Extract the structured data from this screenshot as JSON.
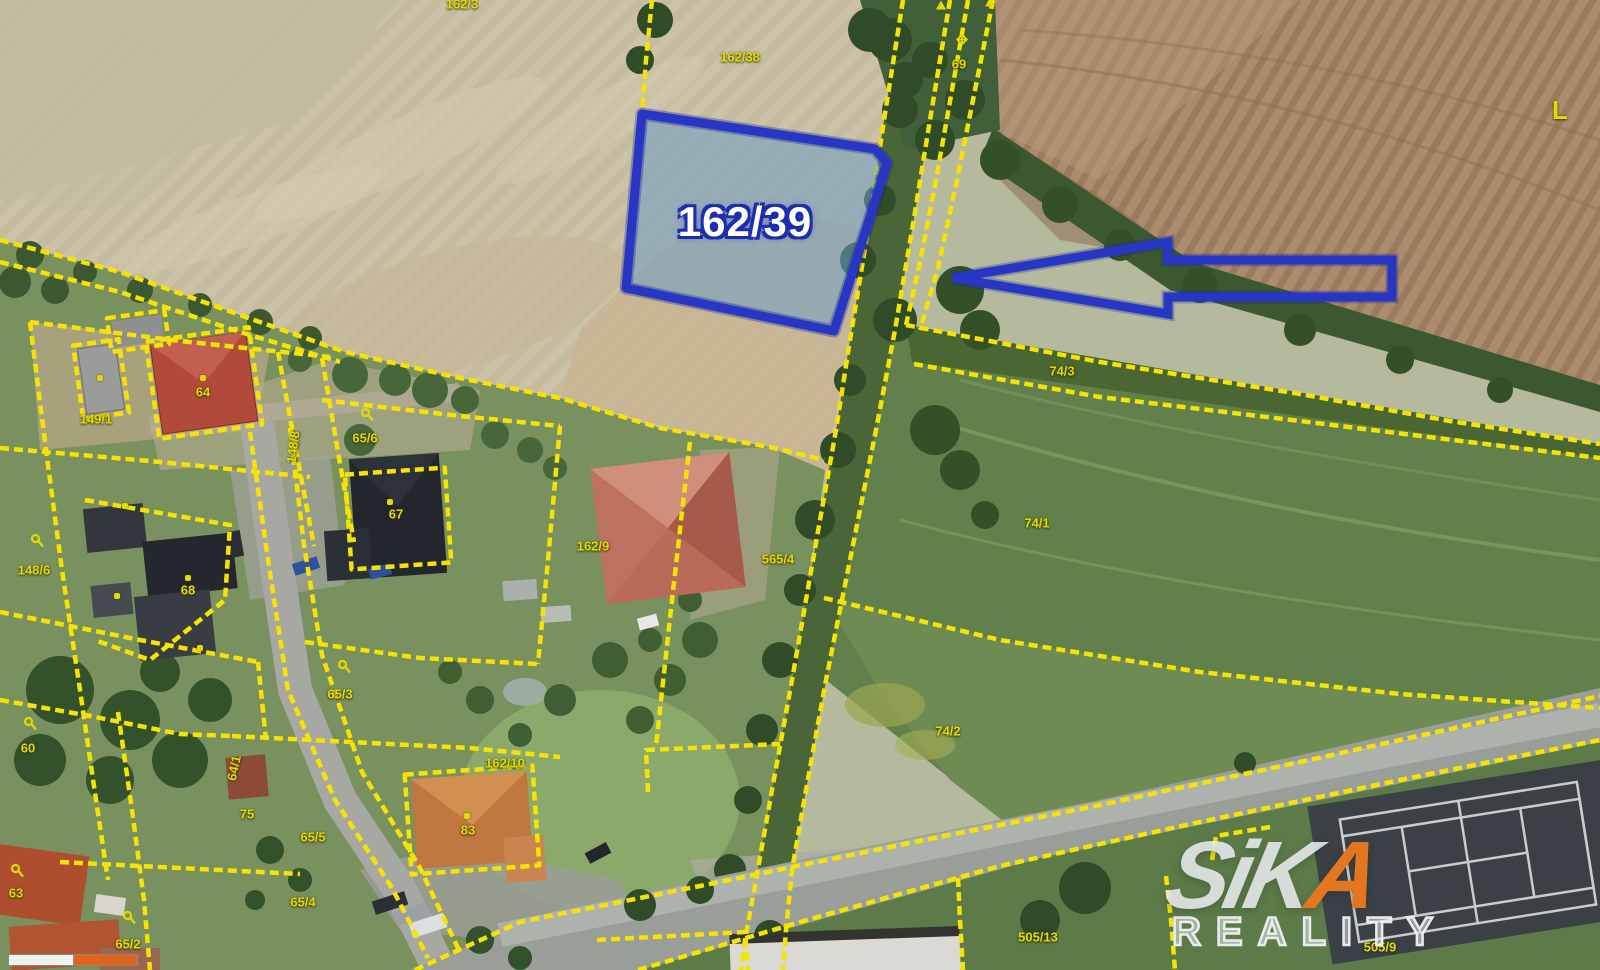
{
  "colors": {
    "highlight_blue": "#2836c4",
    "highlight_fill": "#6d9ec7",
    "boundary_yellow": "#f6e400",
    "label_yellow": "#e3da00",
    "brand_orange": "#e4761f"
  },
  "map": {
    "highlight_parcel": {
      "label": "162/39"
    },
    "labels": [
      {
        "text": "162/3",
        "x": 462,
        "y": 4
      },
      {
        "text": "162/38",
        "x": 740,
        "y": 57
      },
      {
        "text": "69",
        "x": 959,
        "y": 64
      },
      {
        "text": "L",
        "x": 1560,
        "y": 110,
        "size": 26
      },
      {
        "text": "74/3",
        "x": 1062,
        "y": 371
      },
      {
        "text": "74/1",
        "x": 1037,
        "y": 523
      },
      {
        "text": "74/2",
        "x": 948,
        "y": 731
      },
      {
        "text": "64",
        "x": 203,
        "y": 392
      },
      {
        "text": "148/8",
        "x": 293,
        "y": 447,
        "rot": -83
      },
      {
        "text": "149/1",
        "x": 96,
        "y": 419
      },
      {
        "text": "65/6",
        "x": 365,
        "y": 438
      },
      {
        "text": "67",
        "x": 396,
        "y": 514
      },
      {
        "text": "162/9",
        "x": 593,
        "y": 546
      },
      {
        "text": "565/4",
        "x": 778,
        "y": 559
      },
      {
        "text": "148/6",
        "x": 34,
        "y": 570
      },
      {
        "text": "68",
        "x": 188,
        "y": 590
      },
      {
        "text": "60",
        "x": 28,
        "y": 748
      },
      {
        "text": "65/3",
        "x": 340,
        "y": 694
      },
      {
        "text": "64/1",
        "x": 234,
        "y": 768,
        "rot": -78
      },
      {
        "text": "162/10",
        "x": 505,
        "y": 763
      },
      {
        "text": "83",
        "x": 468,
        "y": 830
      },
      {
        "text": "65/5",
        "x": 313,
        "y": 837
      },
      {
        "text": "75",
        "x": 247,
        "y": 814
      },
      {
        "text": "65/4",
        "x": 303,
        "y": 902
      },
      {
        "text": "63",
        "x": 16,
        "y": 893
      },
      {
        "text": "65/2",
        "x": 128,
        "y": 944
      },
      {
        "text": "505/13",
        "x": 1038,
        "y": 937
      },
      {
        "text": "505/9",
        "x": 1380,
        "y": 947
      }
    ],
    "dot_markers": [
      {
        "x": 203,
        "y": 378
      },
      {
        "x": 100,
        "y": 378
      },
      {
        "x": 125,
        "y": 506
      },
      {
        "x": 390,
        "y": 502
      },
      {
        "x": 188,
        "y": 578
      },
      {
        "x": 117,
        "y": 596
      },
      {
        "x": 200,
        "y": 648
      },
      {
        "x": 467,
        "y": 816
      }
    ],
    "p_symbols": [
      {
        "x": 38,
        "y": 544
      },
      {
        "x": 368,
        "y": 418
      },
      {
        "x": 345,
        "y": 670
      },
      {
        "x": 31,
        "y": 727
      },
      {
        "x": 18,
        "y": 874
      },
      {
        "x": 130,
        "y": 921
      }
    ],
    "markers": [
      {
        "type": "survey-marker",
        "x": 962,
        "y": 42
      },
      {
        "type": "up-arrow",
        "x": 990,
        "y": 7
      },
      {
        "type": "up-arrow",
        "x": 941,
        "y": 10
      }
    ]
  },
  "watermark": {
    "brand_prefix": "SiK",
    "brand_accent": "A",
    "brand_sub": "REALITY"
  },
  "scale_bar": {
    "type": "map-scale",
    "segments": [
      "white",
      "orange"
    ]
  }
}
